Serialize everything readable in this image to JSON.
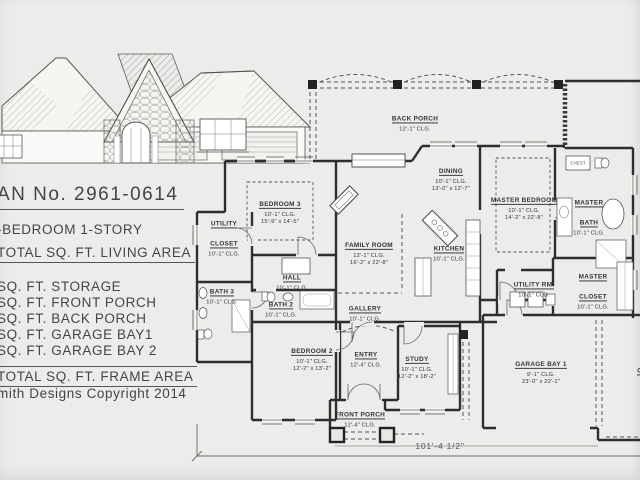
{
  "title_block": {
    "plan_no": "AN No. 2961-0614",
    "plan_type": "-BEDROOM  1-STORY",
    "living_area": "TOTAL SQ. FT. LIVING AREA",
    "items": [
      "SQ. FT. STORAGE",
      "SQ. FT. FRONT PORCH",
      "SQ. FT. BACK PORCH",
      "SQ. FT. GARAGE BAY1",
      "SQ. FT. GARAGE BAY 2"
    ],
    "frame_area": "TOTAL SQ. FT. FRAME AREA",
    "copyright": "mith Designs Copyright 2014"
  },
  "floor_plan": {
    "rooms": [
      {
        "name": "BACK PORCH",
        "clg": "12'-1\" CLG.",
        "dims": ""
      },
      {
        "name": "DINING",
        "clg": "10'-1\" CLG.",
        "dims": "13'-0\" x 12'-7\""
      },
      {
        "name": "MASTER BEDROOM",
        "clg": "10'-1\" CLG.",
        "dims": "14'-2\" x 22'-8\""
      },
      {
        "name": "MASTER BATH",
        "clg": "10'-1\" CLG.",
        "dims": ""
      },
      {
        "name": "MASTER CLOSET",
        "clg": "10'-1\" CLG.",
        "dims": ""
      },
      {
        "name": "BEDROOM 3",
        "clg": "10'-1\" CLG.",
        "dims": "15'-9\" x 14'-5\""
      },
      {
        "name": "UTILITY CLOSET",
        "clg": "10'-1\" CLG.",
        "dims": ""
      },
      {
        "name": "FAMILY ROOM",
        "clg": "12'-1\" CLG.",
        "dims": "16'-2\" x 22'-8\""
      },
      {
        "name": "KITCHEN",
        "clg": "10'-1\" CLG.",
        "dims": ""
      },
      {
        "name": "HALL",
        "clg": "10'-1\" CLG.",
        "dims": ""
      },
      {
        "name": "GALLERY",
        "clg": "10'-1\" CLG.",
        "dims": ""
      },
      {
        "name": "BATH 3",
        "clg": "10'-1\" CLG.",
        "dims": ""
      },
      {
        "name": "BATH 2",
        "clg": "10'-1\" CLG.",
        "dims": ""
      },
      {
        "name": "BEDROOM 2",
        "clg": "10'-1\" CLG.",
        "dims": "12'-2\" x 13'-2\""
      },
      {
        "name": "ENTRY",
        "clg": "12'-4\" CLG.",
        "dims": ""
      },
      {
        "name": "STUDY",
        "clg": "10'-1\" CLG.",
        "dims": "12'-2\" x 18'-2\""
      },
      {
        "name": "FRONT PORCH",
        "clg": "12'-4\" CLG.",
        "dims": ""
      },
      {
        "name": "UTILITY RM.",
        "clg": "10'-1\" CLG.",
        "dims": ""
      },
      {
        "name": "GARAGE BAY 1",
        "clg": "9'-1\" CLG.",
        "dims": "23'-0\" x 22'-1\""
      },
      {
        "name": "GARAGE BAY 2",
        "clg": "9'-1\" CLG.",
        "dims": ""
      }
    ],
    "fixture_labels": {
      "chest": "CHEST"
    },
    "overall_width_dim": "101'-4 1/2\""
  }
}
